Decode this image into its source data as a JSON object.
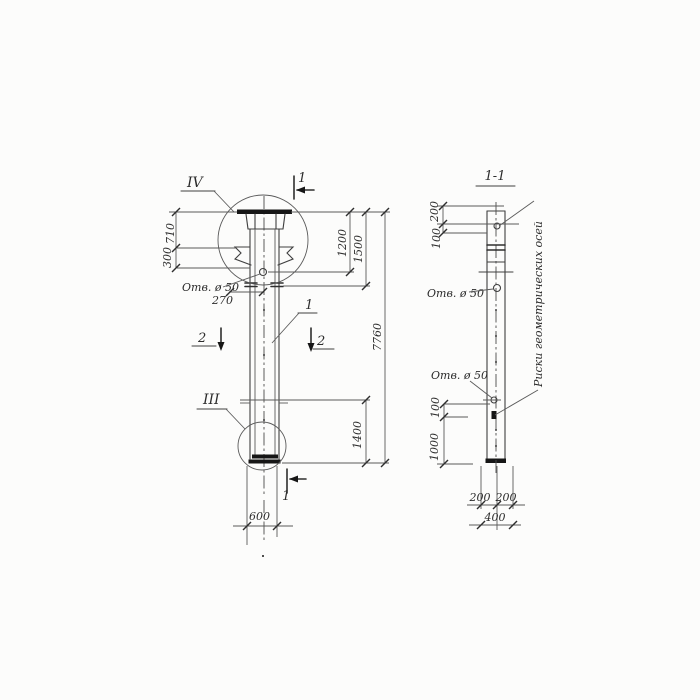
{
  "mv": {
    "marker_top": "IV",
    "marker_bottom": "III",
    "sec_top": "1",
    "sec_bottom": "1",
    "sec_left": "2",
    "sec_right": "2",
    "part": "1",
    "d710": "710",
    "d300": "300",
    "d270": "270",
    "d1200": "1200",
    "d1500": "1500",
    "d7760": "7760",
    "d1400": "1400",
    "d600": "600",
    "hole": "Отв. ø 50"
  },
  "sv": {
    "title": "1-1",
    "d200": "200",
    "d100": "100",
    "d100b": "100",
    "d1000": "1000",
    "d200l": "200",
    "d200r": "200",
    "d400": "400",
    "hole_top": "Отв. ø 50",
    "hole_bottom": "Отв. ø 50",
    "note": "Риски геометрических осей"
  },
  "colors": {
    "ink": "#3f3f3f",
    "ink_dark": "#161616",
    "paper": "#fcfcfb"
  }
}
